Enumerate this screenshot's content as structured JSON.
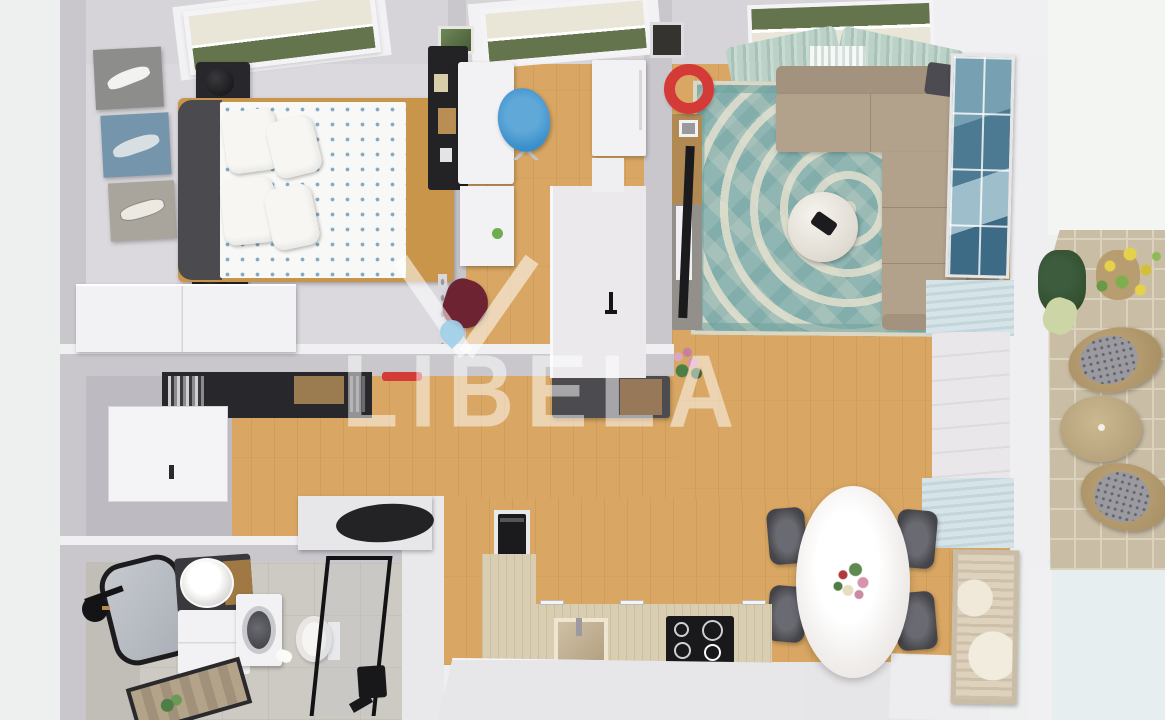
{
  "watermark": {
    "text": "LIBELA",
    "logo": "libela-triangle-droplet-logo"
  },
  "palette": {
    "exterior": "#edf0ee",
    "exterior_right": "#e7eeef",
    "wood": "#d9a763",
    "wall": "#c9c7cc",
    "wall_top": "#f0eff2",
    "wall_face": "#bdbbc1",
    "bedroom_floor": "#dbd9dd",
    "bath_floor": "#cdc9c3",
    "bath_wall": "#c1bdb7",
    "white_furn": "#f2f1f3",
    "island": "#e7e6e8",
    "rug": "#8fb6b2",
    "rug_pattern": "#e7e2d0",
    "rug_dark": "#6da09d",
    "sofa": "#b2a18b",
    "sofa_dark": "#a3927d",
    "curtain": "#b9cfc5",
    "headboard": "#4a4a4f",
    "bed_wood": "#c8954b",
    "duvet_dot": "#84a9c2",
    "black_furn": "#28272b",
    "red": "#d43b38",
    "maroon": "#6d2331",
    "chair_blue": "#3f93cc",
    "counter_oak": "#d9ceb2",
    "cooktop": "#19191b",
    "table_white": "#f7f5f3",
    "chair_dining": "#55545a",
    "paving": "#c9bda5",
    "paving_line": "#dbd2bd",
    "wicker": "#b49b71",
    "cushion_gray": "#9a9aa0",
    "green_dark": "#33502f",
    "green": "#6fae4e",
    "yellow": "#e5d24a",
    "pink": "#d795ad",
    "art_blue": "#4d7a93",
    "art_beige": "#ded2bd",
    "blind_blue": "#cfe0e5",
    "cream_blind": "#e9e5d7",
    "glass_green": "#64744d",
    "droplet": "#9fd0e8",
    "watermark_white": "rgba(255,255,255,0.5)"
  },
  "scene": {
    "type": "3d-floor-plan-top-down-render",
    "rooms": [
      {
        "name": "bedroom",
        "items": [
          "double-bed",
          "blue-pattern-duvet",
          "four-pillows",
          "dark-headboard",
          "two-black-nightstands",
          "two-table-lamps",
          "boat-triptych-wall-art",
          "white-wardrobe",
          "roof-window-with-blind"
        ]
      },
      {
        "name": "home-office",
        "items": [
          "white-desk",
          "blue-office-chair",
          "black-wall-organizer",
          "white-tall-cabinet",
          "roof-window-with-blind",
          "green-wall-photo"
        ]
      },
      {
        "name": "living-room",
        "items": [
          "beige-corner-sofa",
          "teal-oriental-rug",
          "round-coffee-table",
          "tv-console-with-tv",
          "red-round-mirror",
          "blue-abstract-wall-art",
          "sage-curtains",
          "window",
          "dark-throw"
        ]
      },
      {
        "name": "hallway",
        "items": [
          "black-wall-shelf-with-books",
          "red-wall-accent",
          "coat-rack-with-maroon-coat",
          "white-door",
          "gray-bench-with-wood-drawer",
          "white-counter",
          "pink-orchid-plant",
          "side-table-black-top"
        ]
      },
      {
        "name": "kitchen",
        "items": [
          "l-shaped-oak-counter",
          "induction-cooktop",
          "built-in-oven-tower",
          "kitchen-sink",
          "white-peninsula"
        ]
      },
      {
        "name": "dining-area",
        "items": [
          "white-oval-table",
          "flower-bouquet",
          "four-dark-chairs",
          "beige-framed-wall-art",
          "light-blue-window-blinds"
        ]
      },
      {
        "name": "bathroom",
        "items": [
          "black-round-mirror",
          "black-wall-lamp",
          "round-washbasin",
          "dark-vanity-with-wood",
          "white-base-cabinet",
          "washing-machine",
          "toilet",
          "black-framed-shower-glass",
          "framed-bath-mat-with-plant"
        ]
      },
      {
        "name": "balcony",
        "items": [
          "stone-paving",
          "two-wicker-chairs-gray-cushions",
          "round-side-table",
          "yellow-flower-plant",
          "dark-green-plant",
          "green-cushion"
        ]
      }
    ]
  }
}
